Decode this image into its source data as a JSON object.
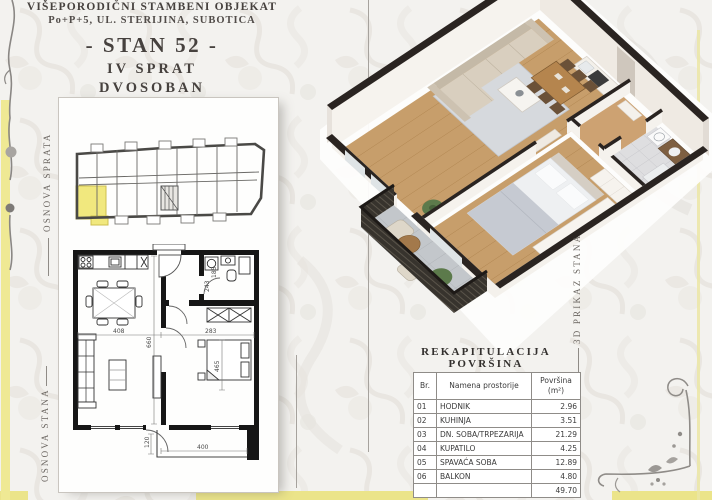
{
  "title_block": {
    "building": "VIŠEPORODIČNI STAMBENI OBJEKAT",
    "address": "Po+P+5, UL. STERIJINA, SUBOTICA",
    "unit": "- STAN 52 -",
    "floor": "IV SPRAT",
    "apartment_type": "DVOSOBAN"
  },
  "side_labels": {
    "floor_overview": "OSNOVA SPRATA",
    "apartment_plan": "OSNOVA STANA",
    "render_3d": "3D PRIKAZ STANA"
  },
  "plan_dimensions": {
    "living_width": "408",
    "living_length": "660",
    "bedroom_width": "283",
    "bedroom_length": "465",
    "bath_a": "243",
    "bath_b": "185",
    "balcony_depth": "120",
    "balcony_width": "400"
  },
  "recap_table": {
    "title": "REKAPITULACIJA POVRŠINA",
    "col_br": "Br.",
    "col_name": "Namena prostorije",
    "col_area": "Površina",
    "col_area_unit": "(m²)",
    "rows": [
      {
        "br": "01",
        "name": "HODNIK",
        "area": "2.96"
      },
      {
        "br": "02",
        "name": "KUHINJA",
        "area": "3.51"
      },
      {
        "br": "03",
        "name": "DN. SOBA/TRPEZARIJA",
        "area": "21.29"
      },
      {
        "br": "04",
        "name": "KUPATILO",
        "area": "4.25"
      },
      {
        "br": "05",
        "name": "SPAVAĆA SOBA",
        "area": "12.89"
      },
      {
        "br": "06",
        "name": "BALKON",
        "area": "4.80"
      }
    ],
    "total": "49.70"
  },
  "colors": {
    "accent_yellow": "#efe994",
    "highlight_unit": "#f1e87e",
    "wall_dark": "#2a2421",
    "wood_floor": "#c79e6b"
  }
}
